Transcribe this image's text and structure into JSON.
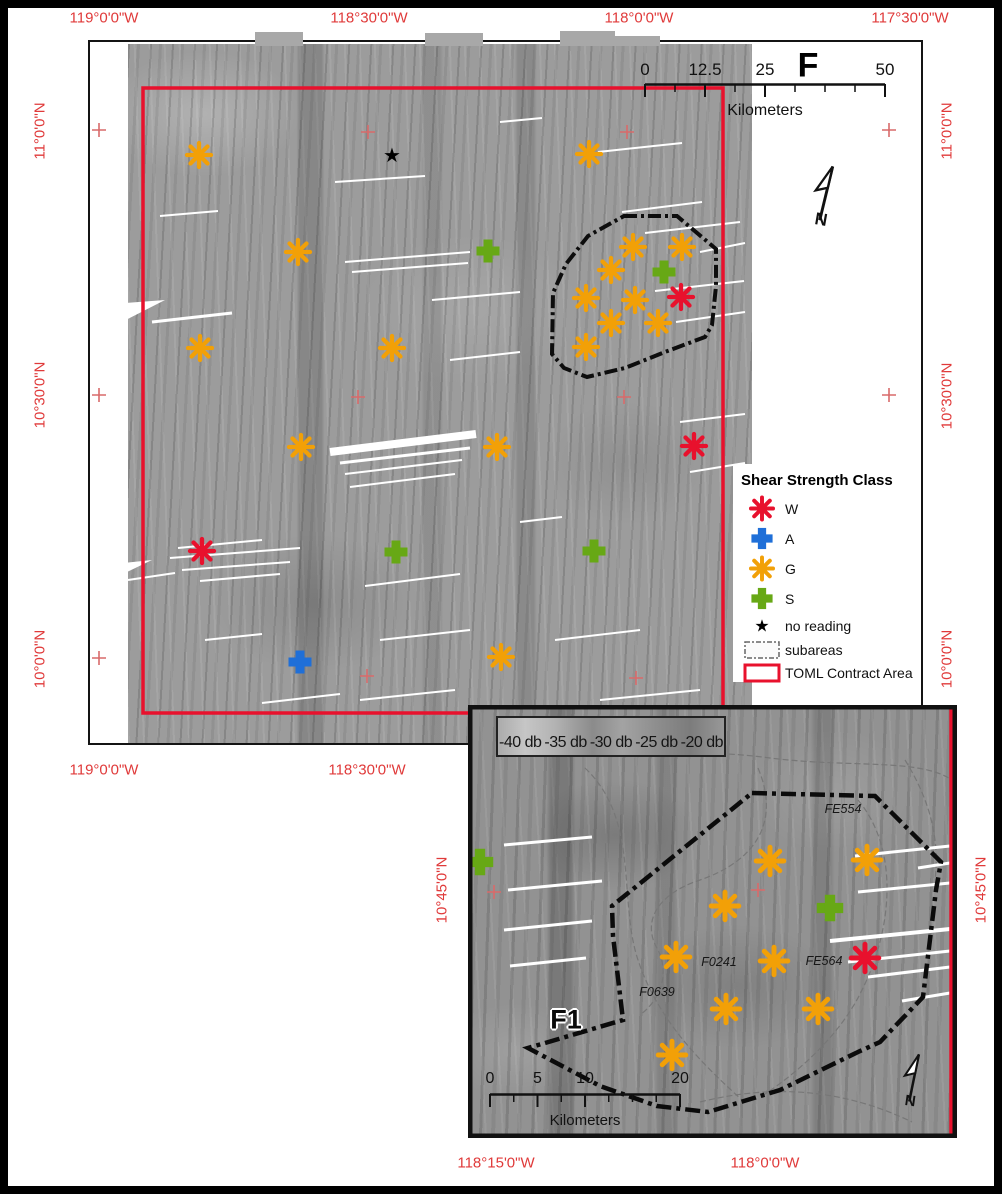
{
  "colors": {
    "label_red": "#E03A3A",
    "cross_red": "#D96A6A",
    "contract_red": "#E8112D",
    "class_w": "#E8112D",
    "class_a": "#1F6FD8",
    "class_g": "#F2A007",
    "class_s": "#67A815",
    "no_reading": "#000000"
  },
  "geo_labels": [
    {
      "text": "119°0'0\"W",
      "x": 104,
      "y": 18,
      "rot": 0
    },
    {
      "text": "118°30'0\"W",
      "x": 369,
      "y": 18,
      "rot": 0
    },
    {
      "text": "118°0'0\"W",
      "x": 639,
      "y": 18,
      "rot": 0
    },
    {
      "text": "117°30'0\"W",
      "x": 910,
      "y": 18,
      "rot": 0
    },
    {
      "text": "119°0'0\"W",
      "x": 104,
      "y": 770,
      "rot": 0
    },
    {
      "text": "118°30'0\"W",
      "x": 367,
      "y": 770,
      "rot": 0
    },
    {
      "text": "118°15'0\"W",
      "x": 496,
      "y": 1163,
      "rot": 0
    },
    {
      "text": "118°0'0\"W",
      "x": 765,
      "y": 1163,
      "rot": 0
    },
    {
      "text": "11°0'0\"N",
      "x": 40,
      "y": 131,
      "rot": -90
    },
    {
      "text": "10°30'0\"N",
      "x": 40,
      "y": 395,
      "rot": -90
    },
    {
      "text": "10°0'0\"N",
      "x": 40,
      "y": 659,
      "rot": -90
    },
    {
      "text": "11°0'0\"N",
      "x": 947,
      "y": 131,
      "rot": -90
    },
    {
      "text": "10°30'0\"N",
      "x": 947,
      "y": 396,
      "rot": -90
    },
    {
      "text": "10°0'0\"N",
      "x": 947,
      "y": 659,
      "rot": -90
    },
    {
      "text": "10°45'0\"N",
      "x": 442,
      "y": 890,
      "rot": -90
    },
    {
      "text": "10°45'0\"N",
      "x": 981,
      "y": 890,
      "rot": -90
    }
  ],
  "main_map": {
    "label_f": "F",
    "scalebar": {
      "x": 645,
      "y": 60,
      "w": 240,
      "fs": 17,
      "unit": "Kilometers",
      "ticks": [
        {
          "f": 0,
          "label": "0"
        },
        {
          "f": 0.25,
          "label": "12.5"
        },
        {
          "f": 0.5,
          "label": "25"
        },
        {
          "f": 1,
          "label": "50"
        }
      ],
      "minors": [
        0.125,
        0.375,
        0.625,
        0.75,
        0.875
      ]
    },
    "legend": {
      "title": "Shear Strength Class",
      "items": [
        {
          "sym": "asterisk",
          "color": "class_w",
          "label": "W"
        },
        {
          "sym": "plus",
          "color": "class_a",
          "label": "A"
        },
        {
          "sym": "asterisk",
          "color": "class_g",
          "label": "G"
        },
        {
          "sym": "plus",
          "color": "class_s",
          "label": "S"
        },
        {
          "sym": "star",
          "color": "no_reading",
          "label": "no reading"
        },
        {
          "sym": "rect_dash",
          "color": "",
          "label": "subareas"
        },
        {
          "sym": "rect_red",
          "color": "contract_red",
          "label": "TOML Contract Area"
        }
      ]
    },
    "north_arrow": {
      "x": 826,
      "y": 198,
      "rot": 10,
      "s": 1.15
    },
    "contract_rect": {
      "x": 143,
      "y": 88,
      "w": 580,
      "h": 625
    },
    "subarea_polygon": [
      [
        624,
        216
      ],
      [
        677,
        216
      ],
      [
        716,
        249
      ],
      [
        716,
        286
      ],
      [
        712,
        325
      ],
      [
        705,
        337
      ],
      [
        665,
        352
      ],
      [
        625,
        368
      ],
      [
        587,
        377
      ],
      [
        564,
        368
      ],
      [
        552,
        354
      ],
      [
        553,
        293
      ],
      [
        566,
        264
      ],
      [
        588,
        236
      ]
    ],
    "crosses": [
      [
        99,
        130
      ],
      [
        889,
        130
      ],
      [
        99,
        395
      ],
      [
        889,
        395
      ],
      [
        99,
        658
      ],
      [
        368,
        132
      ],
      [
        627,
        132
      ],
      [
        358,
        397
      ],
      [
        624,
        397
      ],
      [
        367,
        676
      ],
      [
        636,
        678
      ]
    ],
    "markers": [
      {
        "cls": "G",
        "x": 199,
        "y": 155
      },
      {
        "cls": "G",
        "x": 589,
        "y": 154
      },
      {
        "cls": "G",
        "x": 298,
        "y": 252
      },
      {
        "cls": "G",
        "x": 633,
        "y": 247
      },
      {
        "cls": "G",
        "x": 682,
        "y": 247
      },
      {
        "cls": "G",
        "x": 611,
        "y": 270
      },
      {
        "cls": "G",
        "x": 586,
        "y": 298
      },
      {
        "cls": "G",
        "x": 635,
        "y": 300
      },
      {
        "cls": "G",
        "x": 611,
        "y": 323
      },
      {
        "cls": "G",
        "x": 658,
        "y": 323
      },
      {
        "cls": "G",
        "x": 586,
        "y": 347
      },
      {
        "cls": "G",
        "x": 200,
        "y": 348
      },
      {
        "cls": "G",
        "x": 392,
        "y": 348
      },
      {
        "cls": "G",
        "x": 301,
        "y": 447
      },
      {
        "cls": "G",
        "x": 497,
        "y": 447
      },
      {
        "cls": "G",
        "x": 501,
        "y": 657
      },
      {
        "cls": "W",
        "x": 681,
        "y": 297
      },
      {
        "cls": "W",
        "x": 694,
        "y": 446
      },
      {
        "cls": "W",
        "x": 202,
        "y": 551
      },
      {
        "cls": "A",
        "x": 300,
        "y": 662
      },
      {
        "cls": "S",
        "x": 488,
        "y": 251
      },
      {
        "cls": "S",
        "x": 664,
        "y": 272
      },
      {
        "cls": "S",
        "x": 396,
        "y": 552
      },
      {
        "cls": "S",
        "x": 594,
        "y": 551
      },
      {
        "cls": "N",
        "x": 392,
        "y": 156
      }
    ],
    "top_strips": [
      [
        255,
        32,
        48,
        14
      ],
      [
        425,
        33,
        58,
        13
      ],
      [
        560,
        31,
        55,
        15
      ],
      [
        614,
        36,
        46,
        10
      ]
    ],
    "white_wedges": [
      "100,305 165,300 118,324",
      "96,566 152,560 106,582"
    ],
    "streaks": [
      [
        160,
        216,
        218,
        211,
        2
      ],
      [
        152,
        322,
        232,
        313,
        3
      ],
      [
        178,
        548,
        262,
        540,
        2
      ],
      [
        170,
        558,
        300,
        548,
        2
      ],
      [
        182,
        570,
        290,
        562,
        2
      ],
      [
        200,
        581,
        280,
        574,
        2
      ],
      [
        205,
        640,
        262,
        634,
        2
      ],
      [
        262,
        703,
        340,
        694,
        2
      ],
      [
        335,
        182,
        425,
        176,
        2
      ],
      [
        345,
        262,
        470,
        252,
        2
      ],
      [
        352,
        272,
        468,
        263,
        2
      ],
      [
        330,
        452,
        476,
        434,
        8
      ],
      [
        340,
        463,
        470,
        448,
        3
      ],
      [
        345,
        474,
        462,
        460,
        2
      ],
      [
        350,
        487,
        455,
        474,
        2
      ],
      [
        365,
        586,
        460,
        574,
        2
      ],
      [
        380,
        640,
        470,
        630,
        2
      ],
      [
        360,
        700,
        455,
        690,
        2
      ],
      [
        432,
        300,
        520,
        292,
        2
      ],
      [
        500,
        122,
        542,
        118,
        2
      ],
      [
        450,
        360,
        520,
        352,
        2
      ],
      [
        555,
        640,
        640,
        630,
        2
      ],
      [
        600,
        700,
        700,
        690,
        2
      ],
      [
        520,
        522,
        562,
        517,
        2
      ],
      [
        598,
        152,
        682,
        143,
        2
      ],
      [
        622,
        212,
        702,
        202,
        2
      ],
      [
        645,
        233,
        740,
        222,
        2
      ],
      [
        655,
        291,
        744,
        281,
        2
      ],
      [
        676,
        322,
        745,
        312,
        2
      ],
      [
        680,
        422,
        745,
        414,
        2
      ],
      [
        690,
        472,
        745,
        463,
        2
      ],
      [
        700,
        252,
        745,
        243,
        2
      ],
      [
        128,
        580,
        175,
        573,
        2
      ]
    ]
  },
  "inset_map": {
    "label": "F1",
    "db_labels": [
      "-40 db",
      "-35 db",
      "-30 db",
      "-25 db",
      "-20 db"
    ],
    "scalebar": {
      "x": 490,
      "y": 1070,
      "w": 190,
      "fs": 16,
      "unit": "Kilometers",
      "ticks": [
        {
          "f": 0,
          "label": "0"
        },
        {
          "f": 0.25,
          "label": "5"
        },
        {
          "f": 0.5,
          "label": "10"
        },
        {
          "f": 1,
          "label": "20"
        }
      ],
      "minors": [
        0.125,
        0.375,
        0.625,
        0.75,
        0.875
      ]
    },
    "north_arrow": {
      "x": 914,
      "y": 1082,
      "rot": 8,
      "s": 1.0
    },
    "red_line_x": 951,
    "area_labels": [
      {
        "text": "FE554",
        "x": 843,
        "y": 809
      },
      {
        "text": "F0241",
        "x": 719,
        "y": 962
      },
      {
        "text": "FE564",
        "x": 824,
        "y": 961
      },
      {
        "text": "F0639",
        "x": 657,
        "y": 992
      }
    ],
    "subarea_polygon": [
      [
        752,
        793
      ],
      [
        875,
        796
      ],
      [
        941,
        862
      ],
      [
        936,
        890
      ],
      [
        923,
        997
      ],
      [
        880,
        1042
      ],
      [
        858,
        1052
      ],
      [
        780,
        1090
      ],
      [
        708,
        1112
      ],
      [
        657,
        1106
      ],
      [
        600,
        1086
      ],
      [
        528,
        1048
      ],
      [
        623,
        1020
      ],
      [
        613,
        936
      ],
      [
        612,
        906
      ]
    ],
    "outlines": [
      "M560,733 C620,758 700,748 770,758 C850,768 920,758 952,780",
      "M585,768 C640,820 618,900 638,960 C658,1020 700,1062 742,1100",
      "M758,768 C780,820 758,860 700,880 C660,893 640,920 658,950 C670,975 660,1000 640,1015",
      "M858,800 C900,850 892,930 862,990 C842,1032 802,1070 762,1096",
      "M700,1102 C780,1082 850,1092 912,1122",
      "M905,760 C930,800 940,840 935,880"
    ],
    "crosses": [
      [
        494,
        892
      ],
      [
        758,
        890
      ]
    ],
    "markers": [
      {
        "cls": "G",
        "x": 770,
        "y": 861
      },
      {
        "cls": "G",
        "x": 867,
        "y": 860
      },
      {
        "cls": "G",
        "x": 725,
        "y": 906
      },
      {
        "cls": "G",
        "x": 676,
        "y": 957
      },
      {
        "cls": "G",
        "x": 774,
        "y": 961
      },
      {
        "cls": "G",
        "x": 726,
        "y": 1009
      },
      {
        "cls": "G",
        "x": 818,
        "y": 1009
      },
      {
        "cls": "G",
        "x": 672,
        "y": 1055
      },
      {
        "cls": "S",
        "x": 480,
        "y": 862
      },
      {
        "cls": "S",
        "x": 830,
        "y": 908
      },
      {
        "cls": "W",
        "x": 865,
        "y": 958
      }
    ],
    "streaks": [
      [
        504,
        845,
        592,
        837,
        3
      ],
      [
        508,
        890,
        602,
        881,
        3
      ],
      [
        504,
        930,
        592,
        921,
        3
      ],
      [
        510,
        966,
        586,
        958,
        3
      ],
      [
        855,
        856,
        950,
        846,
        3
      ],
      [
        858,
        892,
        950,
        883,
        3
      ],
      [
        830,
        941,
        950,
        929,
        4
      ],
      [
        848,
        962,
        950,
        951,
        3
      ],
      [
        868,
        977,
        950,
        967,
        3
      ],
      [
        902,
        1001,
        950,
        993,
        3
      ],
      [
        918,
        868,
        950,
        863,
        3
      ]
    ]
  }
}
